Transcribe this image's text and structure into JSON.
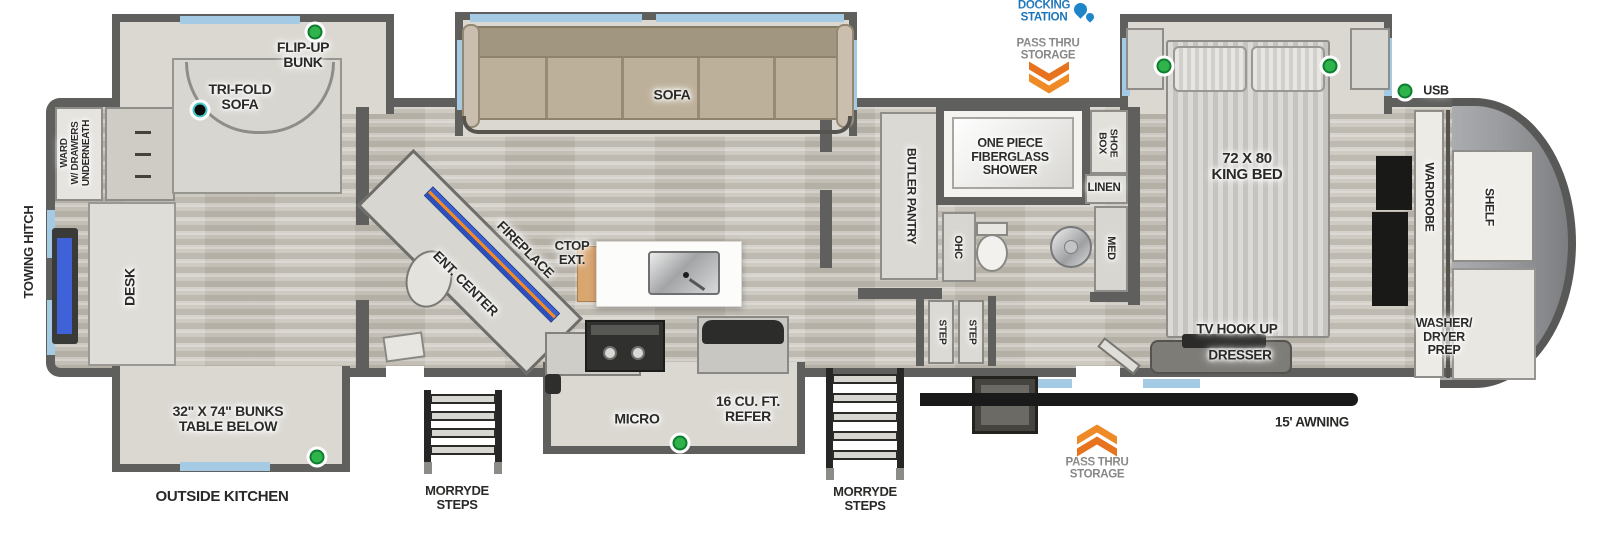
{
  "labels": {
    "flip_up_bunk": "FLIP-UP\nBUNK",
    "tri_fold_sofa": "TRI-FOLD\nSOFA",
    "ward": "WARD\nW/ DRAWERS\nUNDERNEATH",
    "towing_hitch": "TOWING HITCH",
    "desk": "DESK",
    "bunks": "32\" X 74\" BUNKS\nTABLE BELOW",
    "outside_kitchen": "OUTSIDE KITCHEN",
    "morryde_steps": "MORRYDE\nSTEPS",
    "sofa": "SOFA",
    "fireplace": "FIREPLACE",
    "ent_center": "ENT. CENTER",
    "ctop_ext": "CTOP\nEXT.",
    "micro": "MICRO",
    "refer": "16 CU. FT.\nREFER",
    "butler_pantry": "BUTLER PANTRY",
    "shower": "ONE PIECE\nFIBERGLASS\nSHOWER",
    "shoe_box": "SHOE\nBOX",
    "linen": "LINEN",
    "ohc": "OHC",
    "med": "MED",
    "step": "STEP",
    "king_bed": "72 X 80\nKING BED",
    "tv_hook_up": "TV HOOK UP",
    "dresser": "DRESSER",
    "wardrobe": "WARDROBE",
    "shelf": "SHELF",
    "washer_dryer_prep": "WASHER/\nDRYER\nPREP",
    "docking_station": "DOCKING\nSTATION",
    "pass_thru_storage": "PASS THRU\nSTORAGE",
    "awning": "15' AWNING",
    "usb": "USB"
  },
  "colors": {
    "wall": "#5f5f5d",
    "floor": "#cbc7be",
    "window_blue": "#a5cae4",
    "green_indicator": "#2eb44a",
    "black_indicator": "#0b0b0b",
    "orange_arrow": "#e8731f",
    "docking_blue": "#1a74b8",
    "pass_thru_gray": "#878785",
    "sofa_tan": "#bdb09a",
    "front_cap_gray": "#9b9da0",
    "awning_black": "#1a1a1a"
  },
  "icons": {
    "water_drop": "water-drop",
    "chevrons_down": "double-chevron-down",
    "chevrons_up": "double-chevron-up",
    "green_dot": "led-indicator",
    "black_dot": "speaker-indicator"
  }
}
